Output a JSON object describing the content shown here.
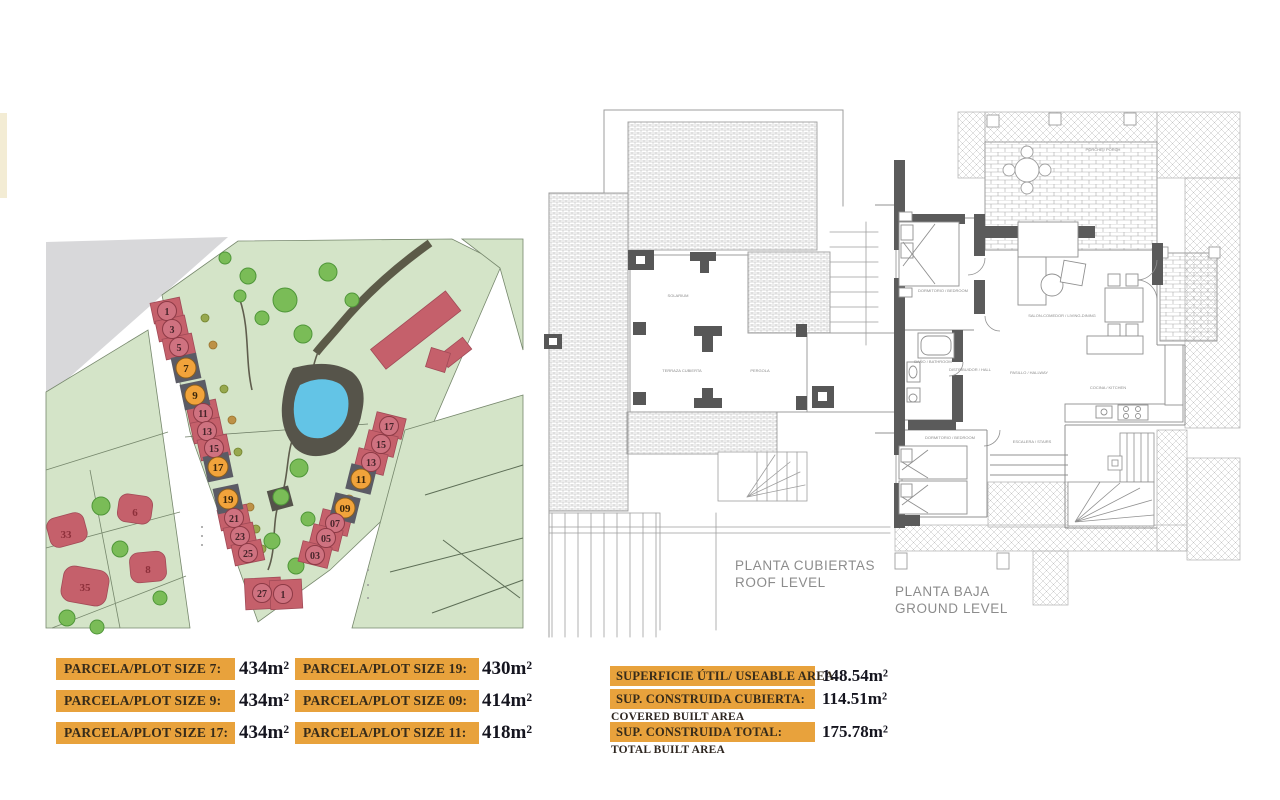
{
  "site_plan": {
    "left_row": [
      "1",
      "3",
      "5",
      "7",
      "9",
      "11",
      "13",
      "15",
      "17",
      "19",
      "21",
      "23",
      "25"
    ],
    "bottom_row": [
      "27",
      "1"
    ],
    "right_row": [
      "17",
      "15",
      "13",
      "11",
      "09",
      "07",
      "05",
      "03"
    ],
    "west_plots": [
      "33",
      "6",
      "8",
      "35"
    ]
  },
  "roof_plan": {
    "caption_es": "PLANTA CUBIERTAS",
    "caption_en": "ROOF LEVEL",
    "labels": [
      "SOLARIUM",
      "TERRAZA CUBIERTA",
      "PERGOLA"
    ]
  },
  "ground_plan": {
    "caption_es": "PLANTA BAJA",
    "caption_en": "GROUND LEVEL",
    "labels": [
      "DORMITORIO / BEDROOM",
      "SALON-COMEDOR / LIVING-DINING",
      "COCINA / KITCHEN",
      "BAÑO / BATHROOM",
      "DISTRIBUIDOR / HALL",
      "DORMITORIO / BEDROOM",
      "PORCHE / PORCH",
      "ESCALERA / STAIRS",
      "PASILLO / HALLWAY"
    ]
  },
  "plot_sizes": {
    "rows": [
      {
        "left_label": "PARCELA/PLOT SIZE 7:",
        "left_value": "434m²",
        "right_label": "PARCELA/PLOT SIZE 19:",
        "right_value": "430m²"
      },
      {
        "left_label": "PARCELA/PLOT SIZE 9:",
        "left_value": "434m²",
        "right_label": "PARCELA/PLOT SIZE 09:",
        "right_value": "414m²"
      },
      {
        "left_label": "PARCELA/PLOT SIZE 17:",
        "left_value": "434m²",
        "right_label": "PARCELA/PLOT SIZE 11:",
        "right_value": "418m²"
      }
    ]
  },
  "area_summary": {
    "rows": [
      {
        "label": "SUPERFICIE ÚTIL/ USEABLE AREA:",
        "sublabel": "",
        "value": "148.54m²"
      },
      {
        "label": "SUP. CONSTRUIDA CUBIERTA:",
        "sublabel": "COVERED BUILT AREA",
        "value": "114.51m²"
      },
      {
        "label": "SUP. CONSTRUIDA TOTAL:",
        "sublabel": "TOTAL BUILT AREA",
        "value": "175.78m²"
      }
    ]
  },
  "colors": {
    "accent_orange": "#e8a23c",
    "plot_red": "#c5606b",
    "highlight_slate": "#5b5b65",
    "highlight_orange": "#f1a33b",
    "grass": "#d4e4c8",
    "tree": "#7abc57",
    "pool": "#63c4e6"
  }
}
